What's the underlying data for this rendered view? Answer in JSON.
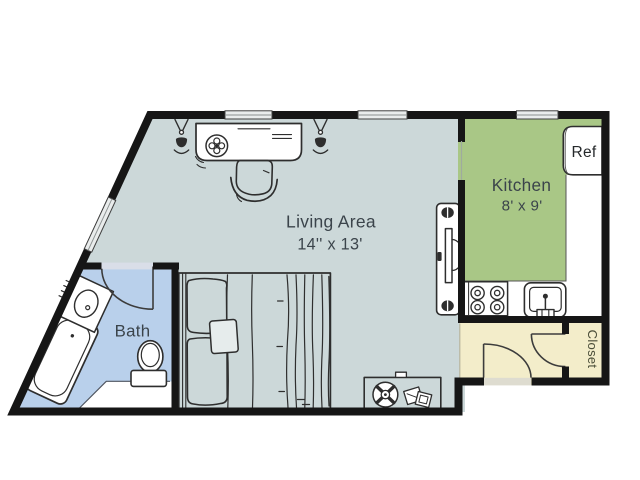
{
  "colors": {
    "wall": "#161616",
    "living_floor": "#ccd8d9",
    "kitchen_floor": "#a9c786",
    "bath_floor": "#b9d0eb",
    "entry_floor": "#f3edca",
    "counter_white": "#ffffff",
    "window_fill": "#e9ecec",
    "furniture_outline": "#2e2e2e",
    "label_text": "#3b444b",
    "closet_text": "#4b4e39"
  },
  "rooms": {
    "living_area": {
      "label": "Living Area",
      "dimensions": "14'' x 13'"
    },
    "kitchen": {
      "label": "Kitchen",
      "dimensions": "8' x 9'"
    },
    "bath": {
      "label": "Bath"
    },
    "closet": {
      "label": "Closet"
    }
  },
  "appliances": {
    "refrigerator_label": "Ref"
  },
  "furniture_icons": [
    "desk",
    "desk-chair",
    "wall-lamp",
    "media-console",
    "tv",
    "double-bed",
    "pillow",
    "side-table",
    "table-fan",
    "books",
    "bathtub",
    "bathroom-sink",
    "toilet",
    "stove",
    "kitchen-sink",
    "refrigerator",
    "door-swing",
    "window"
  ]
}
